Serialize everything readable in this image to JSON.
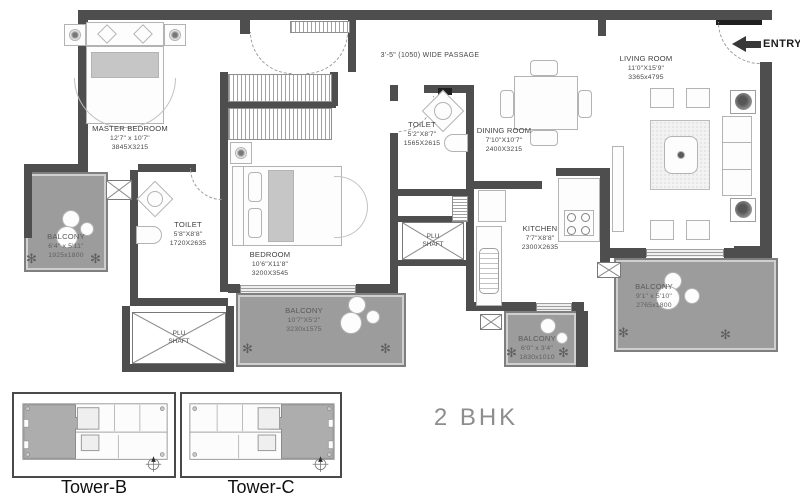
{
  "floor_plan": {
    "unit_type": "2 BHK",
    "entry_label": "ENTRY",
    "passage_label": "3'-5\" (1050) WIDE PASSAGE",
    "rooms": {
      "master_bedroom": {
        "name": "MASTER BEDROOM",
        "size_imperial": "12'7\" x 10'7\"",
        "size_metric": "3845X3215"
      },
      "master_toilet": {
        "name": "TOILET",
        "size_imperial": "5'8\"X8'8\"",
        "size_metric": "1720X2635"
      },
      "common_toilet": {
        "name": "TOILET",
        "size_imperial": "5'2\"X8'7\"",
        "size_metric": "1565X2615"
      },
      "bedroom": {
        "name": "BEDROOM",
        "size_imperial": "10'6\"X11'8\"",
        "size_metric": "3200X3545"
      },
      "dining_room": {
        "name": "DINING ROOM",
        "size_imperial": "7'10\"X10'7\"",
        "size_metric": "2400X3215"
      },
      "kitchen": {
        "name": "KITCHEN",
        "size_imperial": "7'7\"X8'8\"",
        "size_metric": "2300X2635"
      },
      "living_room": {
        "name": "LIVING ROOM",
        "size_imperial": "11'0\"X15'9\"",
        "size_metric": "3365x4795"
      },
      "balcony_master": {
        "name": "BALCONY",
        "size_imperial": "6'4\" x 5'11\"",
        "size_metric": "1925x1800"
      },
      "balcony_bedroom": {
        "name": "BALCONY",
        "size_imperial": "10'7\"X5'2\"",
        "size_metric": "3230x1575"
      },
      "balcony_kitchen": {
        "name": "BALCONY",
        "size_imperial": "6'0\" x 3'4\"",
        "size_metric": "1830x1010"
      },
      "balcony_living": {
        "name": "BALCONY",
        "size_imperial": "9'1\" x 5'10\"",
        "size_metric": "2765x1800"
      },
      "plu_shaft_left": {
        "name": "PLU SHAFT"
      },
      "plu_shaft_mid": {
        "name": "PLU SHAFT"
      }
    },
    "towers": [
      {
        "label": "Tower-B"
      },
      {
        "label": "Tower-C"
      }
    ],
    "icons": {
      "plant": "✻"
    },
    "colors": {
      "wall": "#4e4e4e",
      "balcony_floor": "#9c9c9c",
      "label_text": "#3e3e3e",
      "unit_type_text": "#8d8d8d"
    }
  }
}
